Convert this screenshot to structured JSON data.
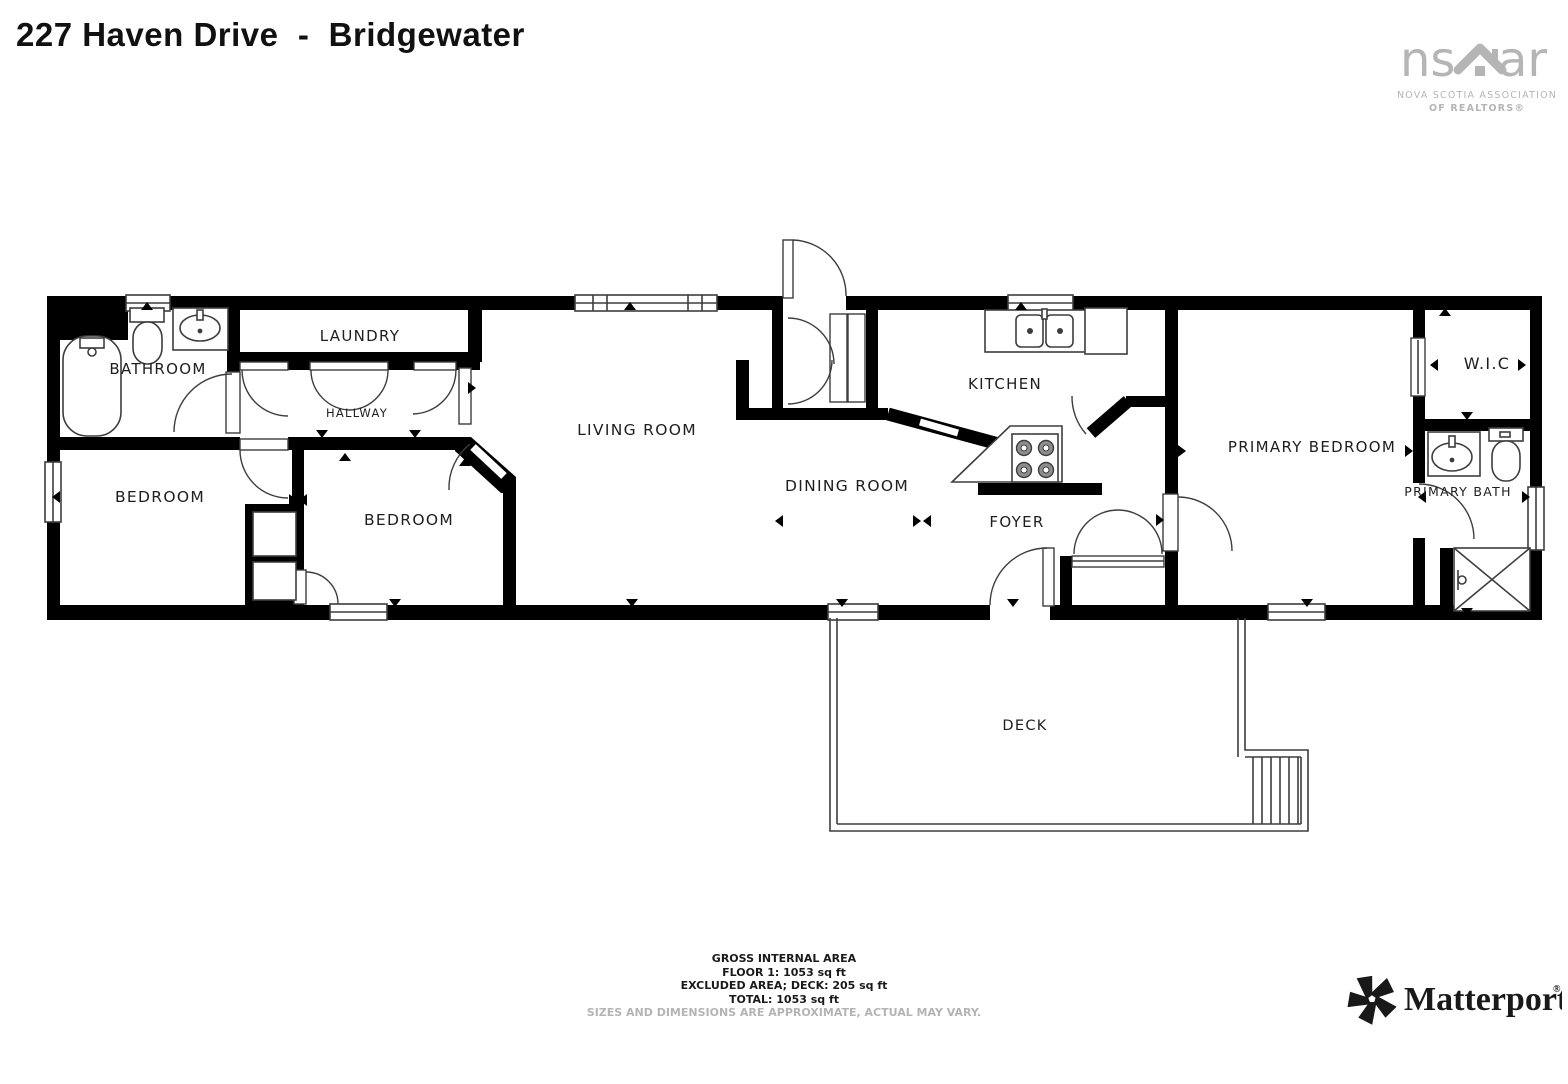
{
  "title": "227 Haven Drive  -  Bridgewater",
  "branding": {
    "nsar": {
      "word_left": "ns",
      "word_right": "ar",
      "tagline1": "NOVA SCOTIA ASSOCIATION",
      "tagline2": "OF REALTORS®",
      "color": "#b5b5b5",
      "icon": "house-roof-icon"
    },
    "matterport": {
      "name": "Matterport",
      "reg_mark": "®",
      "icon": "pinwheel-icon",
      "color": "#191919"
    }
  },
  "floorplan": {
    "wall_color": "#000000",
    "fixture_line_color": "#3d3d3d",
    "rooms": [
      {
        "id": "bathroom",
        "label": "BATHROOM"
      },
      {
        "id": "laundry",
        "label": "LAUNDRY"
      },
      {
        "id": "hallway",
        "label": "HALLWAY"
      },
      {
        "id": "bedroom-left",
        "label": "BEDROOM"
      },
      {
        "id": "bedroom-middle",
        "label": "BEDROOM"
      },
      {
        "id": "living-room",
        "label": "LIVING ROOM"
      },
      {
        "id": "dining-room",
        "label": "DINING ROOM"
      },
      {
        "id": "kitchen",
        "label": "KITCHEN"
      },
      {
        "id": "foyer",
        "label": "FOYER"
      },
      {
        "id": "primary-bedroom",
        "label": "PRIMARY BEDROOM"
      },
      {
        "id": "walk-in-closet",
        "label": "W.I.C"
      },
      {
        "id": "primary-bath",
        "label": "PRIMARY BATH"
      },
      {
        "id": "deck",
        "label": "DECK"
      }
    ],
    "fixtures": [
      "bathtub",
      "toilet",
      "sink",
      "double-kitchen-sink",
      "stove",
      "fridge",
      "shower",
      "stairs"
    ]
  },
  "area_summary": {
    "line1": "GROSS INTERNAL AREA",
    "line2": "FLOOR 1: 1053 sq ft",
    "line3": "EXCLUDED AREA; DECK: 205 sq ft",
    "line4": "TOTAL: 1053 sq ft",
    "disclaimer": "SIZES AND DIMENSIONS ARE APPROXIMATE, ACTUAL MAY VARY."
  }
}
